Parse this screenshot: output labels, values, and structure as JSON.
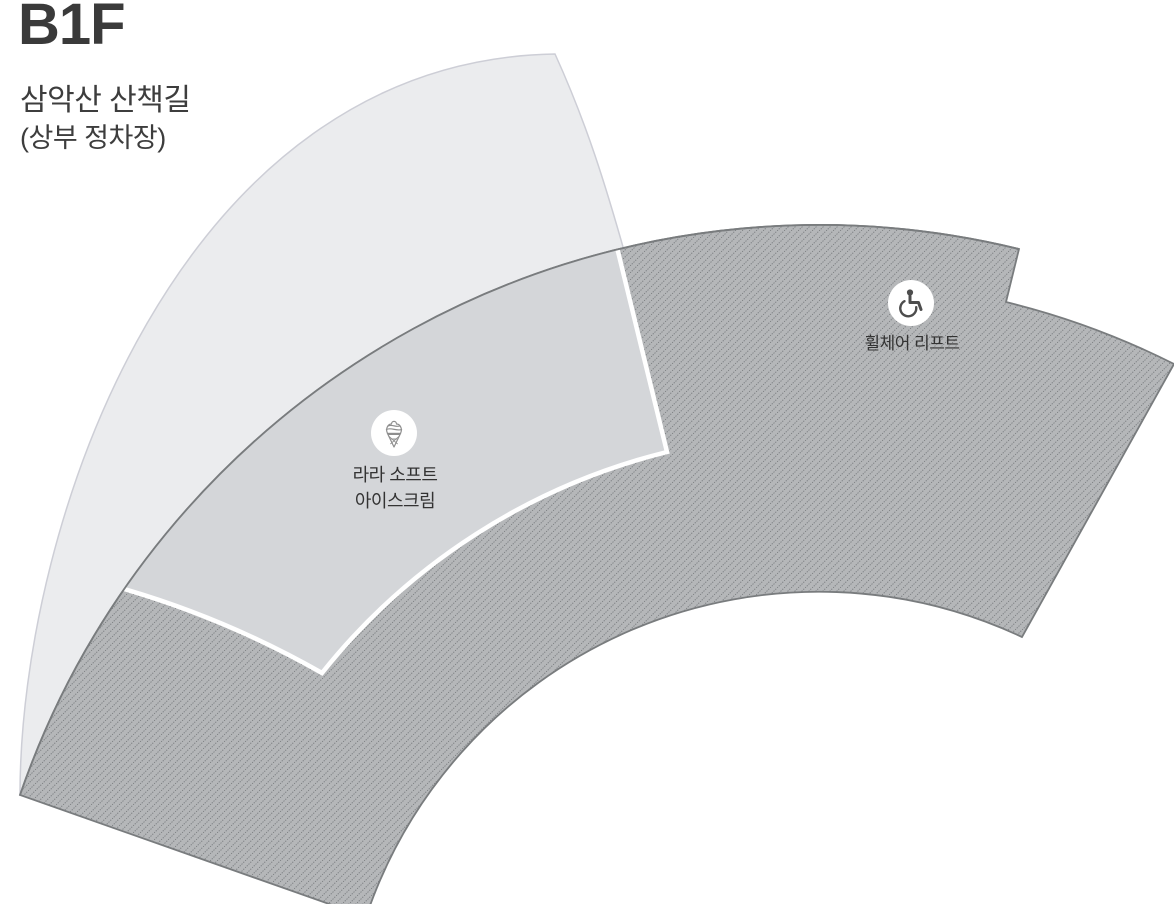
{
  "page": {
    "floor_label": "B1F",
    "location_name": "삼악산 산책길",
    "location_sub": "(상부 정차장)"
  },
  "map": {
    "areas": [
      {
        "id": "upper-walkway-fan",
        "fill": "#ebecee",
        "border": "#cdced6"
      },
      {
        "id": "hatched-zone",
        "fill": "#b5b7b9",
        "hatch_line": "#7e8184",
        "outline": "#797c7e"
      },
      {
        "id": "mid-walkway-band",
        "fill": "#d4d6d9",
        "border": "#ffffff"
      }
    ],
    "pois": [
      {
        "id": "soft-ice-cream",
        "icon": "soft-serve-ice-cream-icon",
        "label_line1": "라라 소프트",
        "label_line2": "아이스크림",
        "marker_fill": "#ffffff",
        "icon_color": "#8e8e8e"
      },
      {
        "id": "wheelchair-lift",
        "icon": "wheelchair-icon",
        "label": "휠체어 리프트",
        "marker_fill": "#ffffff",
        "icon_color": "#4d4d4d"
      }
    ],
    "text_color": "#333333",
    "title_color": "#3a3a3a"
  }
}
